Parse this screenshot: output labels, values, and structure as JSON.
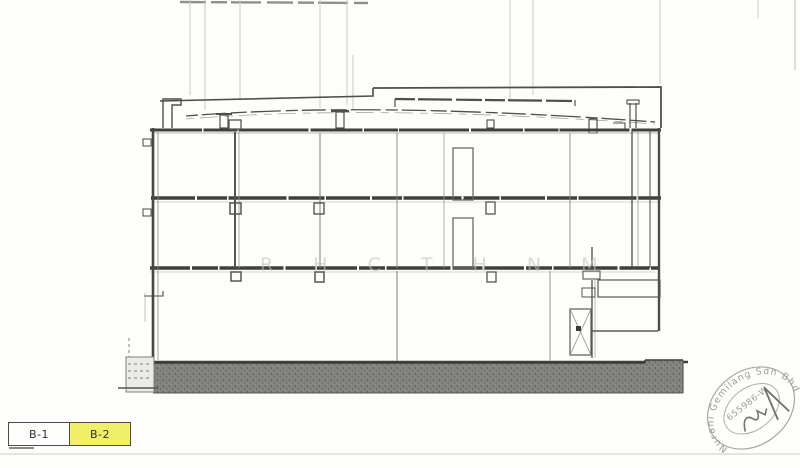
{
  "sheet_tabs": {
    "items": [
      {
        "label": "B-1",
        "active": false
      },
      {
        "label": "B-2",
        "active": true
      }
    ]
  },
  "watermark": {
    "text": "R H C T H N M"
  },
  "stamp": {
    "company_arc": "Nurani Gemilang Sdn Bhd",
    "registration_no": "655986-W"
  },
  "colors": {
    "tab_active": "#f1ef67",
    "stamp_ink": "#8f8f8b",
    "drawing_line": "#4a4a4a",
    "ground_hatch": "#7f7f7c"
  }
}
